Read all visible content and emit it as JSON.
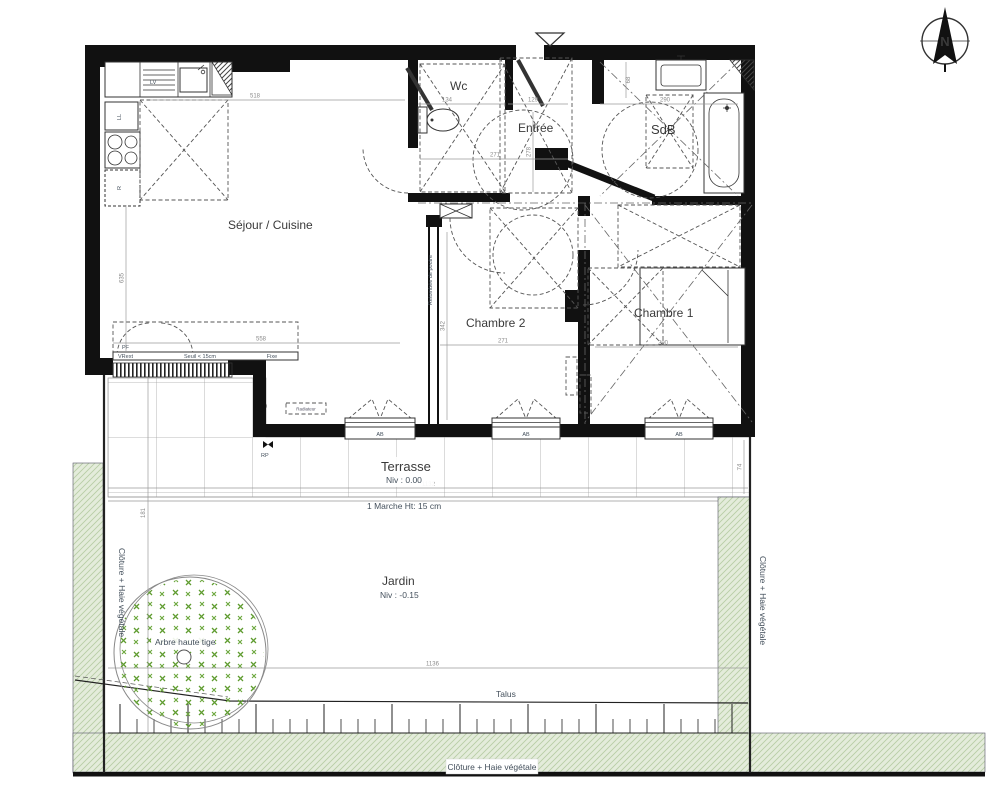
{
  "colors": {
    "wall": "#111111",
    "hedge_fill": "#e4ecdb",
    "hedge_line": "#b8cda6",
    "tree_cross": "#5f9c30",
    "dim_text": "#8b8b8b",
    "label_text": "#3a3a3a"
  },
  "compass": {
    "label": "N"
  },
  "rooms": {
    "sejour": {
      "label": "Séjour / Cuisine"
    },
    "wc": {
      "label": "Wc"
    },
    "entree": {
      "label": "Entrée"
    },
    "sdb": {
      "label": "SdB"
    },
    "chambre2": {
      "label": "Chambre 2"
    },
    "chambre1": {
      "label": "Chambre 1"
    },
    "terrasse": {
      "label": "Terrasse",
      "level": "Niv : 0.00"
    },
    "jardin": {
      "label": "Jardin",
      "level": "Niv : -0.15"
    }
  },
  "openings": {
    "window_label": "AB",
    "door_label_pf": "PF",
    "door_label_vr": "VRext",
    "threshold": "Seuil < 15cm",
    "fixed_panel": "Fixe"
  },
  "appliances": {
    "dishwasher": "LV",
    "washing_machine": "LL",
    "fridge": "R"
  },
  "annotations": {
    "step": "1 Marche Ht: 15 cm",
    "talus": "Talus",
    "tree": "Arbre haute tige",
    "fence_left": "Clôture + Haie végétale",
    "fence_right": "Clôture + Haie végétale",
    "fence_bottom": "Clôture + Haie végétale",
    "beam": "Retombée de poutre",
    "radiator": "Radiateur",
    "rp": "RP"
  },
  "dimensions": {
    "kitchen_width": "518",
    "sejour_width": "558",
    "wc_width": "134",
    "entry_width": "129",
    "hall_width": "271",
    "entry_depth": "278",
    "sdb_width": "290",
    "chambre2_width": "271",
    "chambre2_depth": "342",
    "chambre1_width": "290",
    "terrasse_width": "1132",
    "jardin_width": "1136",
    "kitchen_depth": "635",
    "sdb_niche": "68",
    "terrasse_depth": "181",
    "fence_offset": "74"
  }
}
